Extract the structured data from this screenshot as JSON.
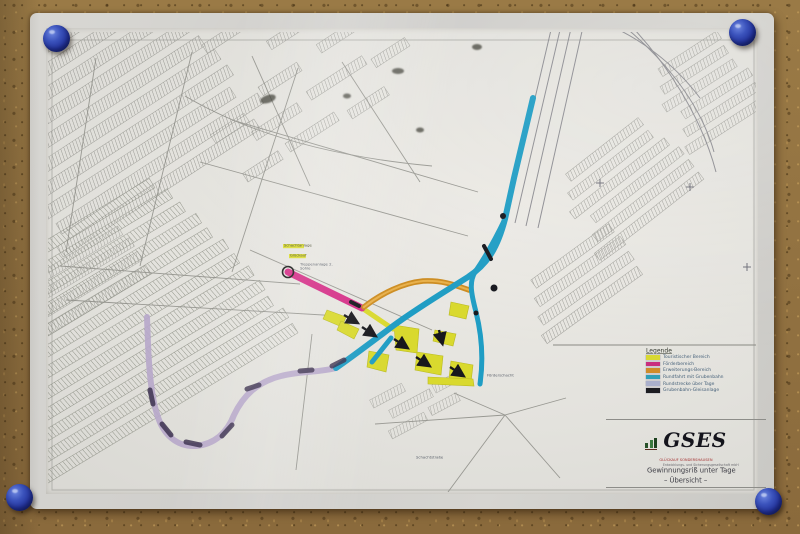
{
  "board": {
    "pin_color": "#2e3f9f",
    "pin_count": 4
  },
  "legend": {
    "title": "Legende",
    "items": [
      {
        "label": "Touristischer Bereich",
        "color": "#d8d832"
      },
      {
        "label": "Förderbereich",
        "color": "#c92f7e"
      },
      {
        "label": "Erweiterungs-Bereich",
        "color": "#cf8c2a"
      },
      {
        "label": "Rundfahrt mit Grubenbahn",
        "color": "#2f9fb8"
      },
      {
        "label": "Rundstrecke über Tage",
        "color": "#aab0cc"
      },
      {
        "label": "Grubenbahn-Gleisanlage",
        "color": "#1d1d22"
      }
    ]
  },
  "title_block": {
    "brand": "GSES",
    "brand_subtitle": "GLÜCKAUF SONDERSHAUSEN",
    "brand_subtitle2": "Entwicklungs- und Sicherungsgesellschaft mbH",
    "title_line1": "Gewinnungsriß unter Tage",
    "title_line2": "– Übersicht –"
  },
  "map_labels": [
    {
      "text": "Schachtanlage"
    },
    {
      "text": "Glückauf"
    },
    {
      "text": "Treppenanlage 2. Sohle"
    },
    {
      "text": "Förderschacht"
    },
    {
      "text": "Schachtstraße"
    }
  ],
  "routes": {
    "cyan_main": {
      "name": "Rundfahrt mit Grubenbahn",
      "color": "#1f9dc4",
      "path": "M533 98 L514 178 L505 219 C497 250 486 265 468 277 C441 294 416 309 393 326 C373 341 352 357 336 368"
    },
    "cyan_branch": {
      "color": "#1f9dc4",
      "path": "M505 219 C495 240 486 256 475 272 C469 282 471 293 476 312 C481 332 484 356 480 384"
    },
    "cyan_spur": {
      "color": "#1f9dc4",
      "path": "M391 338 L372 362"
    },
    "orange": {
      "name": "Erweiterungs-Bereich",
      "color": "#cd8c20",
      "path": "M364 307 C382 293 403 283 423 281 C442 280 455 285 469 290"
    },
    "magenta": {
      "name": "Förderbereich",
      "color": "#d52e87",
      "path": "M288 272 L362 308"
    },
    "yellow_link": {
      "color": "#d9d92e",
      "path": "M362 308 L393 329"
    },
    "purple": {
      "name": "Rundstrecke über Tage",
      "color": "#b7a8ca",
      "path": "M336 368 C316 373 299 371 281 376 C257 382 243 396 234 415 C227 433 215 444 196 446 C177 447 163 435 157 414 C151 396 149 368 148 344 L147 317"
    }
  },
  "chambers": {
    "fill": "#d9d92e",
    "polys": [
      "327,310 346,317 342,327 323,319",
      "341,321 359,329 354,339 337,330",
      "394,325 419,329 417,353 396,350",
      "417,352 443,356 441,375 415,370",
      "435,330 456,334 453,346 433,341",
      "451,361 473,365 471,382 449,378",
      "428,377 473,379 474,386 428,384",
      "451,302 469,306 466,319 449,315",
      "369,351 389,355 386,372 367,367"
    ]
  }
}
